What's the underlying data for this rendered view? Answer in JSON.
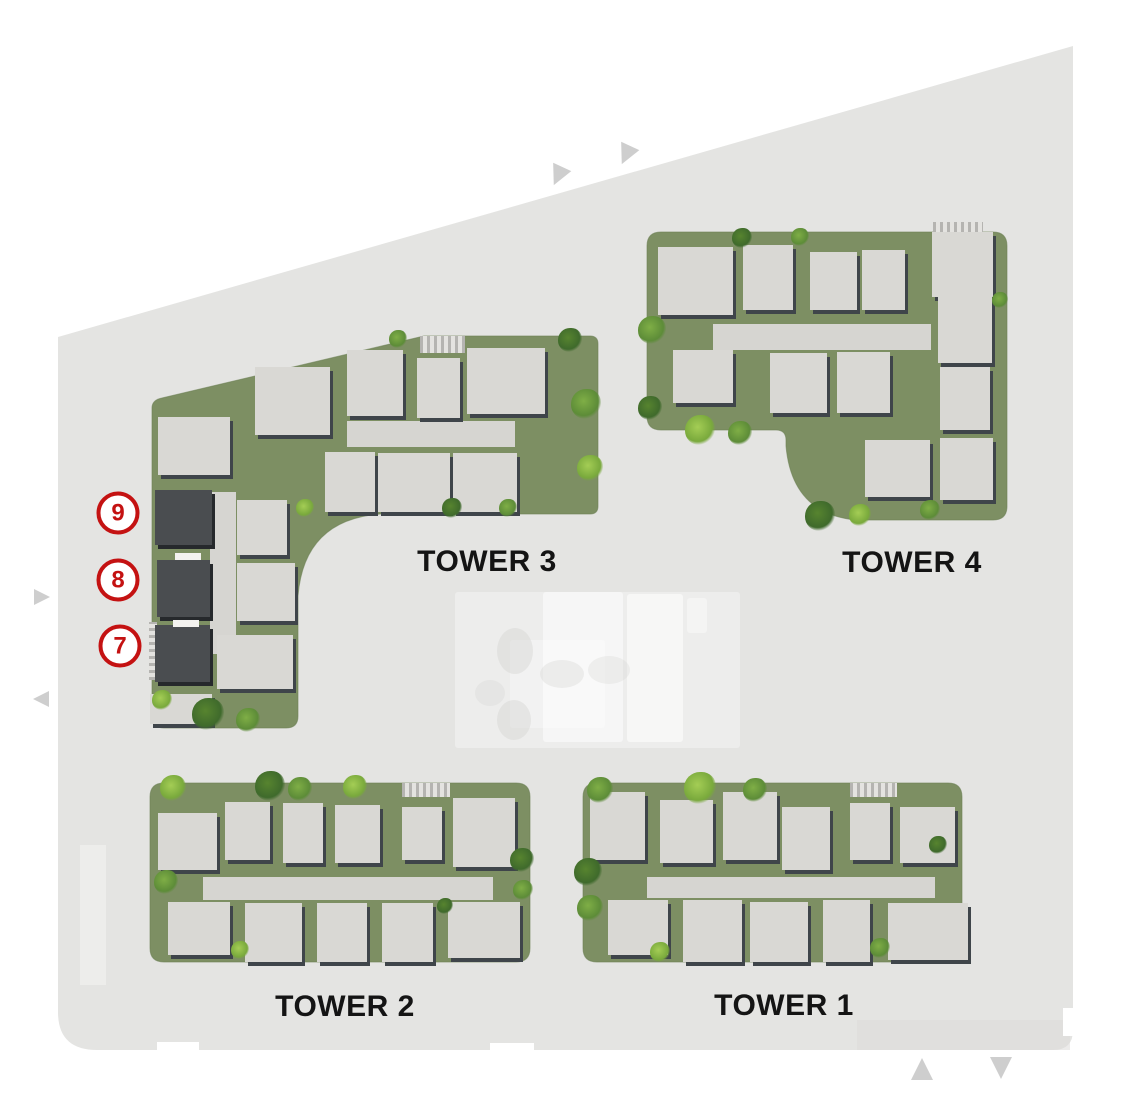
{
  "colors": {
    "site_fill": "#e4e4e2",
    "green": "#7d8f63",
    "green_edge": "#6b7e53",
    "building": "#d9d8d4",
    "building_shadow": "#3f454a",
    "corridor": "#d6d5d1",
    "dark_unit": "#4a4d50",
    "dark_unit_shadow": "#26292c",
    "marker_red": "#c41212",
    "label": "#141414",
    "edge_marker": "#cecece",
    "amenity_spot": "#d4d4d2"
  },
  "map": {
    "site": {
      "path": "M 58 337 L 1073 46 L 1073 1030 Q 1073 1050 1053 1050 L 97 1050 Q 58 1050 58 1012 Z",
      "notches": [
        [
          157,
          1042,
          42,
          12
        ],
        [
          490,
          1043,
          44,
          11
        ],
        [
          1063,
          1008,
          11,
          28
        ]
      ],
      "faint_patches": [
        [
          80,
          845,
          26,
          140,
          "#eeeeec",
          0.85
        ],
        [
          857,
          1020,
          213,
          30,
          "#dcdbd9",
          0.55
        ]
      ]
    },
    "edge_markers": [
      {
        "x": 558,
        "y": 176,
        "size": 20,
        "dir": "down",
        "rot": 25
      },
      {
        "x": 626,
        "y": 155,
        "size": 20,
        "dir": "down",
        "rot": 25
      },
      {
        "x": 42,
        "y": 597,
        "size": 16,
        "dir": "right",
        "rot": 0
      },
      {
        "x": 41,
        "y": 699,
        "size": 16,
        "dir": "left",
        "rot": 0
      },
      {
        "x": 922,
        "y": 1069,
        "size": 22,
        "dir": "up",
        "rot": 0
      },
      {
        "x": 1001,
        "y": 1068,
        "size": 22,
        "dir": "down",
        "rot": 0
      }
    ],
    "amenity": {
      "panels": [
        [
          455,
          592,
          285,
          156,
          0.35
        ],
        [
          543,
          592,
          80,
          150,
          0.5
        ],
        [
          627,
          594,
          56,
          148,
          0.55
        ],
        [
          687,
          598,
          20,
          35,
          0.4
        ],
        [
          510,
          640,
          95,
          88,
          0.3
        ]
      ],
      "spots": [
        [
          497,
          628,
          36,
          46,
          0.45
        ],
        [
          497,
          700,
          34,
          40,
          0.45
        ],
        [
          540,
          660,
          44,
          28,
          0.35
        ],
        [
          588,
          656,
          42,
          28,
          0.3
        ],
        [
          475,
          680,
          30,
          26,
          0.3
        ]
      ]
    },
    "towers": [
      {
        "id": "tower-1",
        "label": "TOWER 1",
        "label_center": [
          784,
          1006
        ],
        "green_path": "M 597 783 H 948 Q 962 783 962 797 V 948 Q 962 962 948 962 H 597 Q 583 962 583 948 V 797 Q 583 783 597 783 Z",
        "buildings": [
          [
            590,
            792,
            55,
            68
          ],
          [
            660,
            800,
            53,
            63
          ],
          [
            723,
            792,
            54,
            68
          ],
          [
            782,
            807,
            48,
            63
          ],
          [
            850,
            803,
            40,
            57
          ],
          [
            900,
            807,
            55,
            56
          ],
          [
            608,
            900,
            60,
            55
          ],
          [
            683,
            900,
            59,
            62
          ],
          [
            750,
            902,
            58,
            60
          ],
          [
            823,
            900,
            47,
            62
          ],
          [
            888,
            903,
            80,
            57
          ]
        ],
        "corridors": [
          [
            647,
            877,
            288,
            21
          ]
        ],
        "ramps": [
          [
            850,
            783,
            47,
            14
          ]
        ],
        "accents": [],
        "dark_units": [],
        "shrubs": [
          [
            600,
            790,
            13,
            "mid"
          ],
          [
            700,
            788,
            16,
            "light"
          ],
          [
            755,
            790,
            12,
            "mid"
          ],
          [
            588,
            872,
            14,
            "dark"
          ],
          [
            590,
            908,
            13,
            "mid"
          ],
          [
            660,
            952,
            10,
            "light"
          ],
          [
            880,
            948,
            10,
            "mid"
          ],
          [
            938,
            845,
            9,
            "dark"
          ]
        ]
      },
      {
        "id": "tower-2",
        "label": "TOWER 2",
        "label_center": [
          345,
          1007
        ],
        "green_path": "M 164 783 H 516 Q 530 783 530 797 V 948 Q 530 962 516 962 H 164 Q 150 962 150 948 V 797 Q 150 783 164 783 Z",
        "buildings": [
          [
            158,
            813,
            59,
            57
          ],
          [
            225,
            802,
            45,
            58
          ],
          [
            283,
            803,
            40,
            60
          ],
          [
            335,
            805,
            45,
            58
          ],
          [
            402,
            807,
            40,
            53
          ],
          [
            453,
            798,
            62,
            69
          ],
          [
            168,
            902,
            62,
            53
          ],
          [
            245,
            903,
            57,
            59
          ],
          [
            317,
            903,
            50,
            59
          ],
          [
            382,
            903,
            51,
            59
          ],
          [
            448,
            902,
            72,
            56
          ]
        ],
        "corridors": [
          [
            203,
            877,
            290,
            23
          ]
        ],
        "ramps": [
          [
            402,
            783,
            48,
            14
          ]
        ],
        "accents": [],
        "dark_units": [],
        "shrubs": [
          [
            173,
            788,
            13,
            "light"
          ],
          [
            270,
            786,
            15,
            "dark"
          ],
          [
            300,
            789,
            12,
            "mid"
          ],
          [
            355,
            787,
            12,
            "light"
          ],
          [
            522,
            860,
            12,
            "dark"
          ],
          [
            523,
            890,
            10,
            "mid"
          ],
          [
            166,
            882,
            12,
            "mid"
          ],
          [
            240,
            950,
            9,
            "light"
          ],
          [
            445,
            906,
            8,
            "dark"
          ]
        ]
      },
      {
        "id": "tower-3",
        "label": "TOWER 3",
        "label_center": [
          487,
          562
        ],
        "green_path": "M 162 398 L 424 336 L 590 336 Q 598 336 598 344 L 598 506 Q 598 514 590 514 L 380 514 Q 304 520 298 596 L 298 716 Q 298 728 286 728 L 164 728 Q 152 728 152 716 L 152 408 Q 152 400 162 398 Z",
        "buildings": [
          [
            158,
            417,
            72,
            58
          ],
          [
            255,
            367,
            75,
            68
          ],
          [
            347,
            350,
            56,
            66
          ],
          [
            417,
            358,
            43,
            60
          ],
          [
            467,
            348,
            78,
            66
          ],
          [
            325,
            452,
            50,
            60
          ],
          [
            378,
            453,
            72,
            59
          ],
          [
            453,
            453,
            64,
            59
          ],
          [
            237,
            500,
            50,
            55
          ],
          [
            237,
            563,
            58,
            58
          ],
          [
            217,
            635,
            76,
            54
          ],
          [
            150,
            694,
            62,
            30
          ]
        ],
        "corridors": [
          [
            347,
            421,
            168,
            26
          ],
          [
            210,
            492,
            26,
            162
          ]
        ],
        "ramps": [
          [
            420,
            336,
            45,
            17
          ],
          [
            149,
            622,
            8,
            58
          ]
        ],
        "accents": [
          [
            175,
            553,
            26,
            7
          ],
          [
            173,
            620,
            26,
            7
          ]
        ],
        "dark_units": [
          {
            "number": "9",
            "rect": [
              155,
              490,
              57,
              55
            ]
          },
          {
            "number": "8",
            "rect": [
              157,
              560,
              53,
              57
            ]
          },
          {
            "number": "7",
            "rect": [
              155,
              625,
              55,
              57
            ]
          }
        ],
        "shrubs": [
          [
            586,
            404,
            15,
            "mid"
          ],
          [
            590,
            468,
            13,
            "light"
          ],
          [
            208,
            714,
            16,
            "dark"
          ],
          [
            248,
            720,
            12,
            "mid"
          ],
          [
            162,
            700,
            10,
            "light"
          ],
          [
            570,
            340,
            12,
            "dark"
          ],
          [
            398,
            339,
            9,
            "mid"
          ],
          [
            305,
            508,
            9,
            "light"
          ],
          [
            452,
            508,
            10,
            "dark"
          ],
          [
            508,
            508,
            9,
            "mid"
          ]
        ]
      },
      {
        "id": "tower-4",
        "label": "TOWER 4",
        "label_center": [
          912,
          563
        ],
        "green_path": "M 661 232 L 993 232 Q 1007 232 1007 246 L 1007 506 Q 1007 520 993 520 L 856 520 Q 792 514 786 446 L 786 440 Q 786 430 776 430 L 661 430 Q 647 430 647 416 L 647 246 Q 647 232 661 232 Z",
        "buildings": [
          [
            658,
            247,
            75,
            68
          ],
          [
            743,
            245,
            50,
            65
          ],
          [
            810,
            252,
            47,
            58
          ],
          [
            862,
            250,
            43,
            60
          ],
          [
            932,
            232,
            61,
            65
          ],
          [
            673,
            350,
            60,
            53
          ],
          [
            770,
            353,
            57,
            60
          ],
          [
            837,
            352,
            53,
            61
          ],
          [
            938,
            297,
            54,
            66
          ],
          [
            940,
            367,
            50,
            63
          ],
          [
            940,
            438,
            53,
            62
          ],
          [
            865,
            440,
            65,
            57
          ]
        ],
        "corridors": [
          [
            713,
            324,
            218,
            26
          ]
        ],
        "ramps": [
          [
            933,
            222,
            50,
            13
          ]
        ],
        "accents": [],
        "dark_units": [],
        "shrubs": [
          [
            652,
            330,
            14,
            "mid"
          ],
          [
            650,
            408,
            12,
            "dark"
          ],
          [
            700,
            430,
            15,
            "light"
          ],
          [
            740,
            433,
            12,
            "mid"
          ],
          [
            820,
            516,
            15,
            "dark"
          ],
          [
            860,
            515,
            11,
            "light"
          ],
          [
            742,
            238,
            10,
            "dark"
          ],
          [
            800,
            237,
            9,
            "mid"
          ],
          [
            1000,
            300,
            8,
            "mid"
          ],
          [
            930,
            510,
            10,
            "mid"
          ]
        ]
      }
    ],
    "unit_markers": [
      {
        "number": "9",
        "cx": 118,
        "cy": 513
      },
      {
        "number": "8",
        "cx": 118,
        "cy": 580
      },
      {
        "number": "7",
        "cx": 120,
        "cy": 646
      }
    ]
  }
}
